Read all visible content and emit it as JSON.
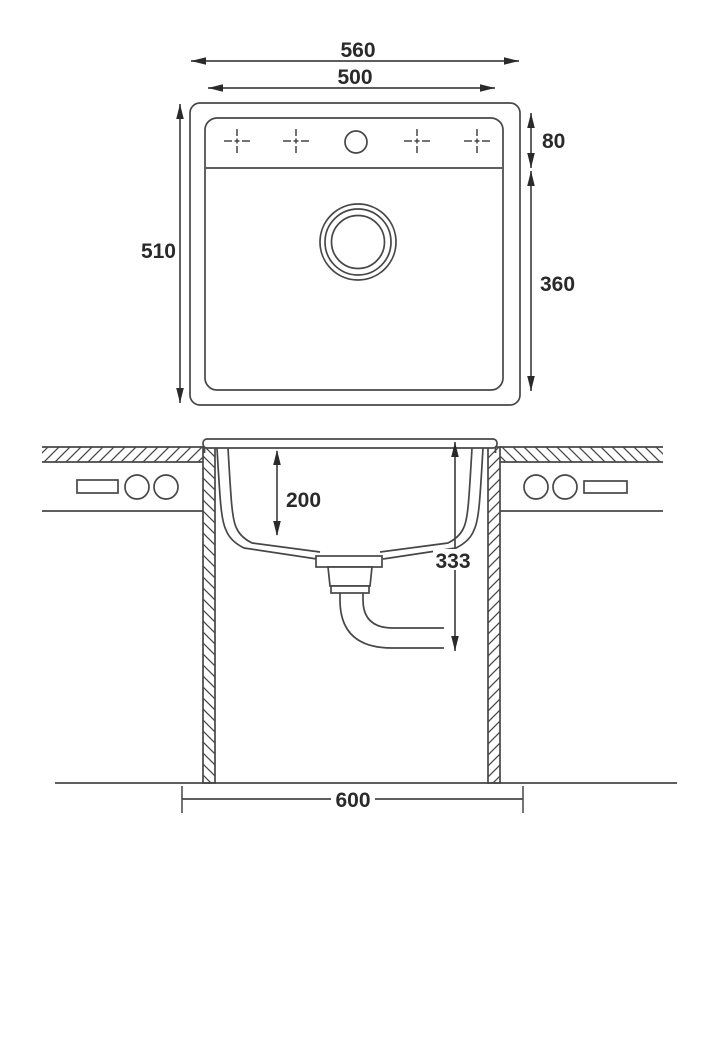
{
  "drawing": {
    "line_color": "#474747",
    "text_color": "#2a2a2a",
    "top_view": {
      "dim_outer_width": "560",
      "dim_inner_width": "500",
      "dim_outer_depth": "510",
      "dim_deck_depth": "80",
      "dim_bowl_length": "360"
    },
    "section_view": {
      "dim_bowl_depth": "200",
      "dim_overall_depth": "333",
      "dim_cabinet_width": "600"
    }
  }
}
